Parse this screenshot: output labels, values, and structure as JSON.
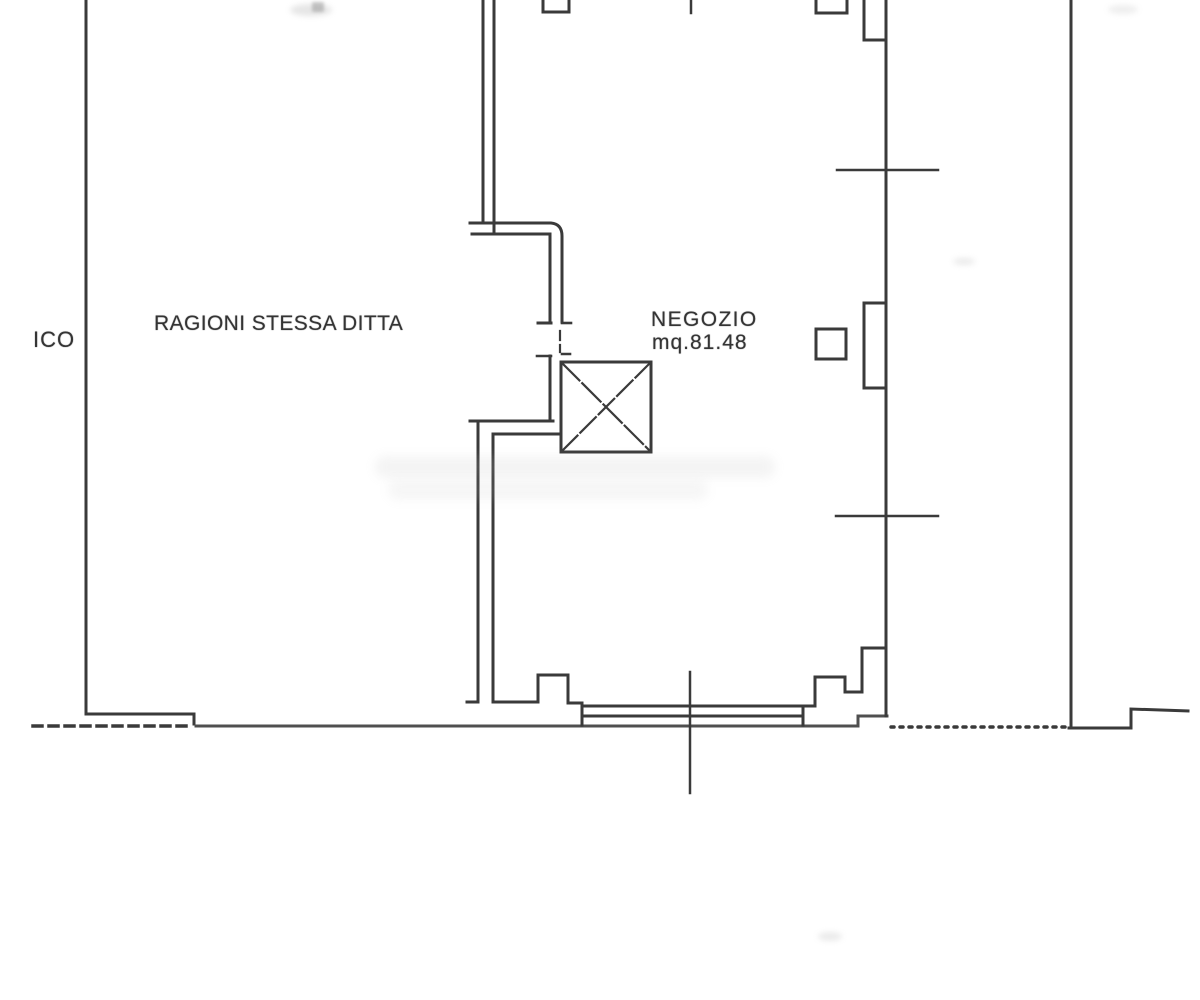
{
  "scan": {
    "background": "#ffffff",
    "ink_color": "#3a3a3a",
    "faded_ink_color": "#4f4f4f"
  },
  "floor_plan": {
    "labels": {
      "adjacent_left_truncated": "ICO",
      "adjacent_property": "RAGIONI STESSA DITTA",
      "room_name": "NEGOZIO",
      "room_area": "mq.81.48"
    }
  }
}
